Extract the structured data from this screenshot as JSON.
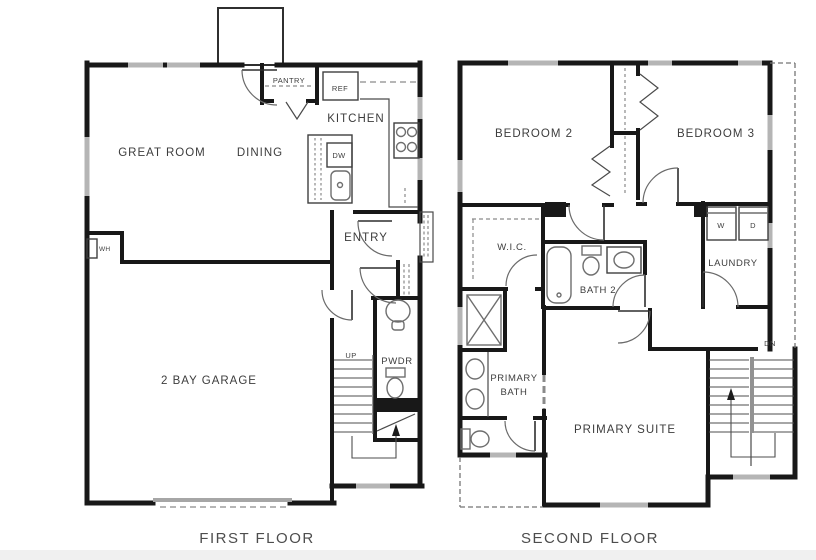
{
  "diagram": {
    "type": "residential-floor-plan",
    "floor_count": 2
  },
  "floor1": {
    "caption": "FIRST FLOOR",
    "rooms": [
      "GREAT ROOM",
      "DINING",
      "KITCHEN",
      "PANTRY",
      "ENTRY",
      "PWDR",
      "2 BAY GARAGE"
    ],
    "labels": {
      "great_room": "GREAT ROOM",
      "dining": "DINING",
      "kitchen": "KITCHEN",
      "pantry": "PANTRY",
      "ref": "REF",
      "dw": "DW",
      "wh": "WH",
      "entry": "ENTRY",
      "up": "UP",
      "pwdr": "PWDR",
      "garage": "2 BAY GARAGE"
    }
  },
  "floor2": {
    "caption": "SECOND FLOOR",
    "rooms": [
      "BEDROOM 2",
      "BEDROOM 3",
      "W.I.C.",
      "BATH 2",
      "LAUNDRY",
      "PRIMARY BATH",
      "PRIMARY SUITE"
    ],
    "labels": {
      "bedroom2": "BEDROOM 2",
      "bedroom3": "BEDROOM 3",
      "wic": "W.I.C.",
      "bath2": "BATH 2",
      "laundry": "LAUNDRY",
      "washer": "W",
      "dryer": "D",
      "primary_bath_line1": "PRIMARY",
      "primary_bath_line2": "BATH",
      "primary_suite": "PRIMARY SUITE",
      "dn": "DN"
    }
  },
  "colors": {
    "wall": "#181818",
    "fixture": "#6e6e6e",
    "window": "#b5b5b5",
    "label_text": "#3d3d3d",
    "caption_text": "#4d4d4d",
    "background": "#ffffff"
  }
}
